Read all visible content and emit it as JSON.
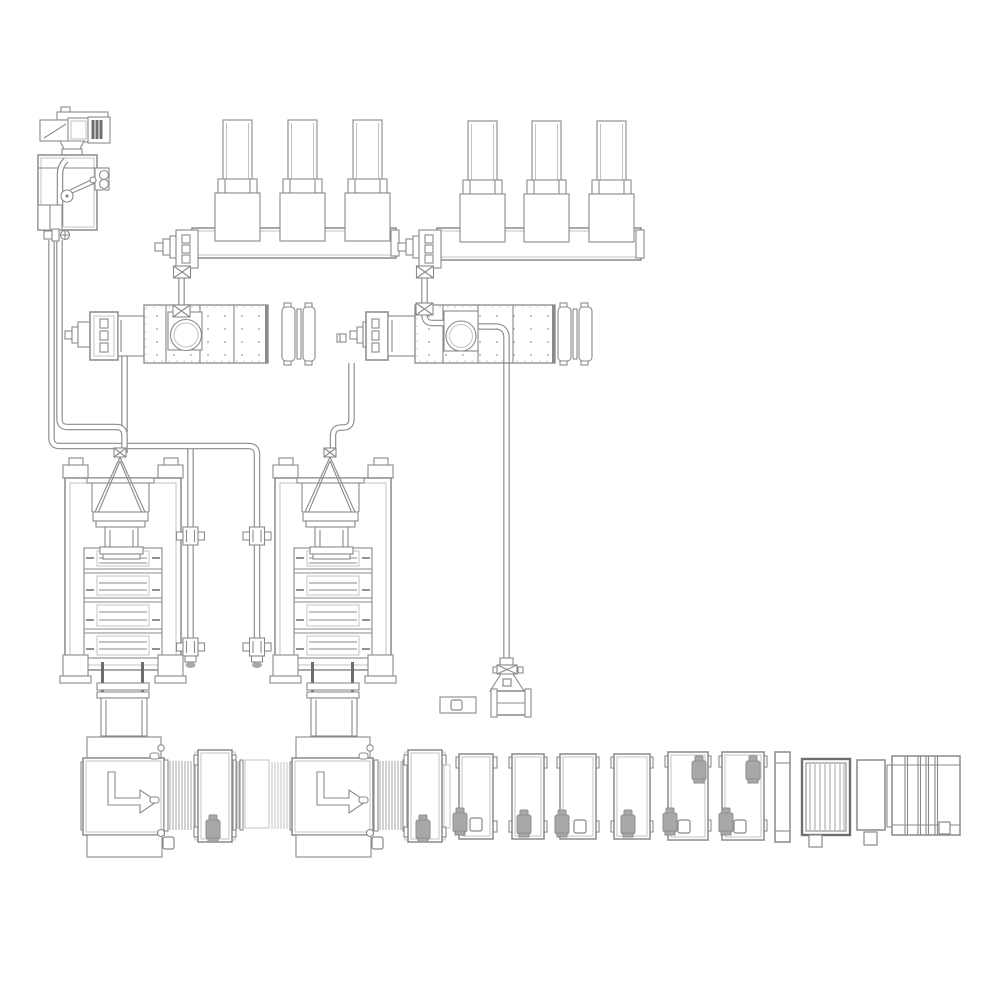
{
  "page": {
    "title": "Synthetic fiber spinning plant — equipment layout engineering drawing",
    "background": "#ffffff"
  },
  "palette": {
    "line": "#8a8a8a",
    "line_dark": "#6d6d6d",
    "line_light": "#c3c3c3",
    "line_mid": "#a6a6a6",
    "motor_fill": "#a8a8a8",
    "motor_dark": "#8f8f8f",
    "dot": "#9a9a9a",
    "background": "#ffffff"
  },
  "components": [
    {
      "id": "chiller-dosing-unit",
      "label": "Chiller / dosing unit"
    },
    {
      "id": "hopper-bank-1",
      "label": "Drying hopper bank 1 (3 hoppers on rail)"
    },
    {
      "id": "hopper-bank-2",
      "label": "Drying hopper bank 2 (3 hoppers on rail)"
    },
    {
      "id": "rail-feeder-1",
      "label": "Rail feeder valve 1"
    },
    {
      "id": "rail-feeder-2",
      "label": "Rail feeder valve 2"
    },
    {
      "id": "crystallizer-dryer-1",
      "label": "Crystallizer dryer 1 with blower loop"
    },
    {
      "id": "crystallizer-dryer-2",
      "label": "Crystallizer dryer 2 with blower loop"
    },
    {
      "id": "blower-1",
      "label": "Process air blower 1"
    },
    {
      "id": "blower-2",
      "label": "Process air blower 2"
    },
    {
      "id": "spinning-tower-1",
      "label": "Spinning tower / press stack 1"
    },
    {
      "id": "spinning-tower-2",
      "label": "Spinning tower / press stack 2"
    },
    {
      "id": "feed-funnel-1",
      "label": "Feed funnel 1"
    },
    {
      "id": "feed-funnel-2",
      "label": "Feed funnel 2"
    },
    {
      "id": "coolant-pipe-run",
      "label": "Coolant / transport pipe run"
    },
    {
      "id": "side-riser-1",
      "label": "Side riser pipe with flanges, tower 1"
    },
    {
      "id": "side-riser-2",
      "label": "Side riser pipe with flanges, tower 2"
    },
    {
      "id": "exhaust-collector",
      "label": "Exhaust drop pipe and collector drum"
    },
    {
      "id": "floor-junction-box",
      "label": "Floor junction box"
    },
    {
      "id": "junction-box",
      "label": "Small junction box"
    },
    {
      "id": "quench-cabinet-1",
      "label": "Quench cabinet 1 (flow arrow)"
    },
    {
      "id": "quench-cabinet-2",
      "label": "Quench cabinet 2 (flow arrow)"
    },
    {
      "id": "interfloor-duct-1",
      "label": "Ribbed interfloor duct 1"
    },
    {
      "id": "interfloor-duct-2",
      "label": "Ribbed interfloor duct 2"
    },
    {
      "id": "interfloor-duct-3",
      "label": "Ribbed interfloor duct 3"
    },
    {
      "id": "interfloor-duct-4",
      "label": "Ribbed interfloor duct 4"
    },
    {
      "id": "godet-cabinet-1",
      "label": "Godet cabinet 1 with drive motor"
    },
    {
      "id": "godet-cabinet-2",
      "label": "Godet cabinet 2 with drive motor"
    },
    {
      "id": "roll-stand-1",
      "label": "Draw roll stand 1"
    },
    {
      "id": "roll-stand-2",
      "label": "Draw roll stand 2"
    },
    {
      "id": "roll-stand-3",
      "label": "Draw roll stand 3"
    },
    {
      "id": "roll-stand-4",
      "label": "Draw roll stand 4"
    },
    {
      "id": "roll-stand-5",
      "label": "Draw roll stand 5"
    },
    {
      "id": "roll-stand-6",
      "label": "Draw roll stand 6"
    },
    {
      "id": "control-panel",
      "label": "Control panel"
    },
    {
      "id": "winder-1",
      "label": "Winder 1 (slatted front)"
    },
    {
      "id": "buffer-box",
      "label": "Buffer cabinet"
    },
    {
      "id": "winder-2",
      "label": "Winder 2 (wide frame)"
    }
  ]
}
